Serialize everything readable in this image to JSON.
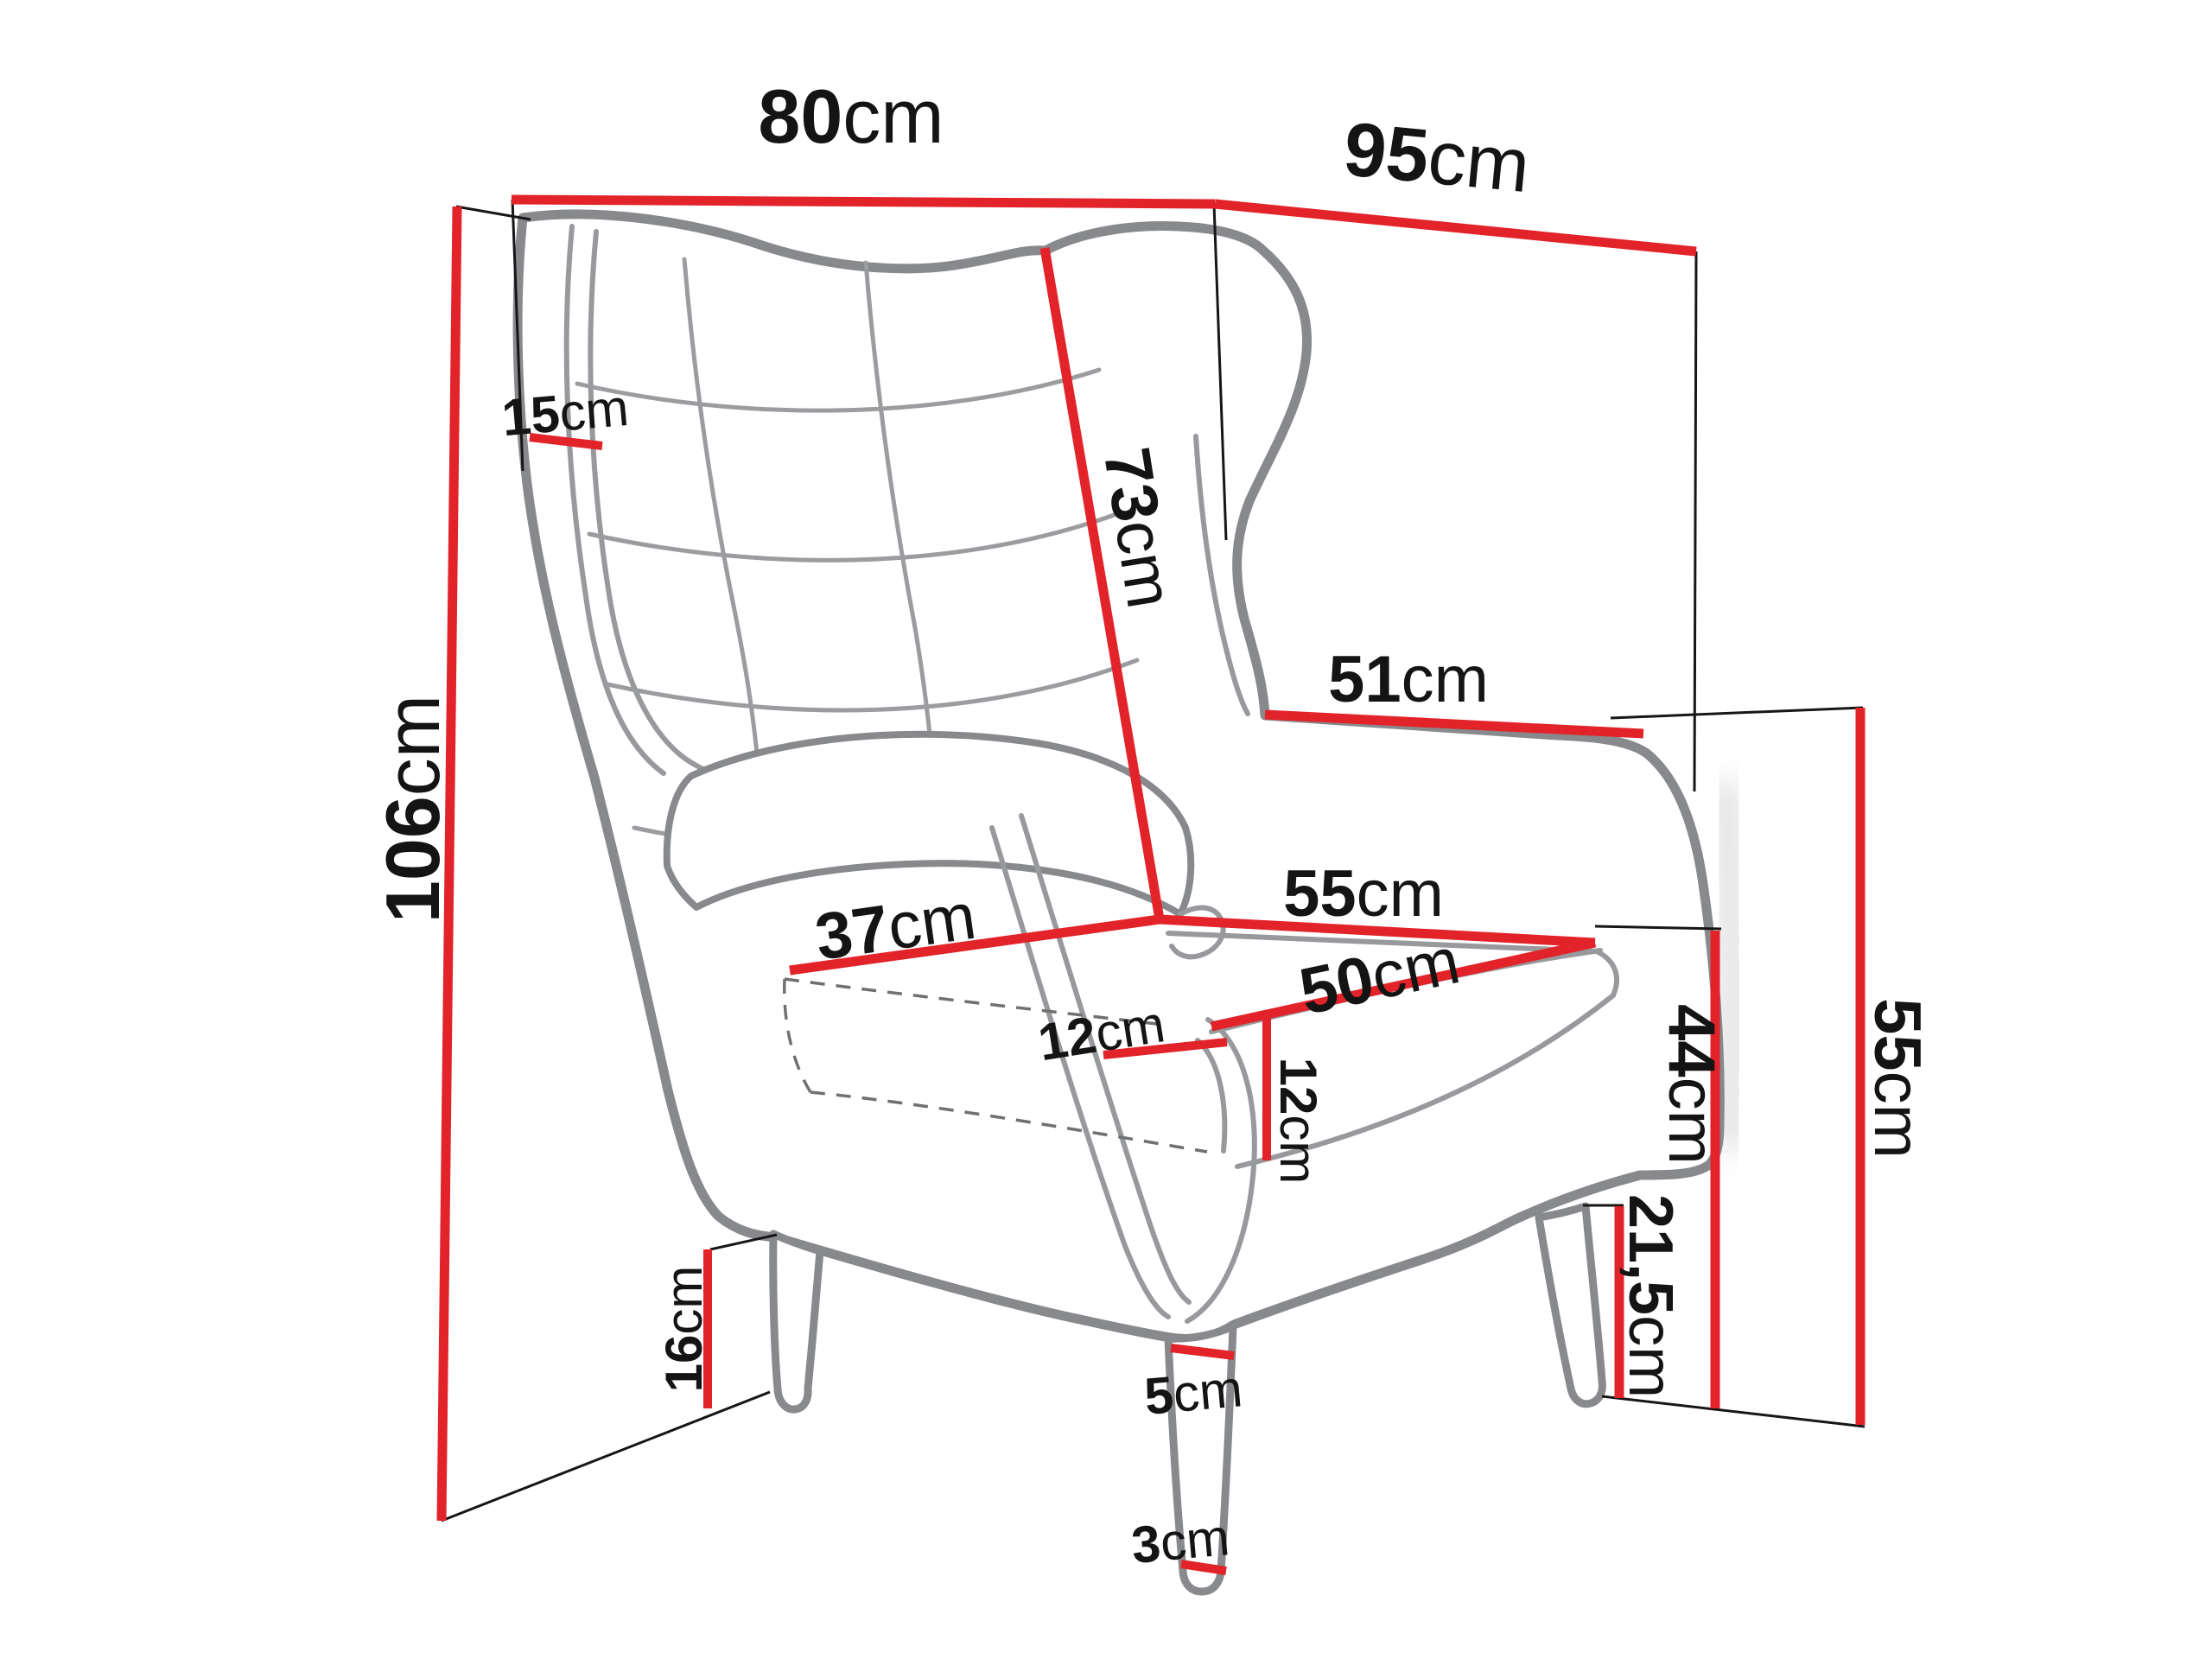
{
  "diagram": {
    "type": "furniture-dimension-drawing",
    "subject": "wingback armchair",
    "unit": "cm",
    "colors": {
      "dimension_line": "#e2232a",
      "chair_outline": "#87898c",
      "label_text": "#141414",
      "background": "#ffffff"
    },
    "dims": {
      "top_width": {
        "value": "80",
        "unit": "cm"
      },
      "top_depth": {
        "value": "95",
        "unit": "cm"
      },
      "total_height": {
        "value": "106",
        "unit": "cm"
      },
      "wing_depth": {
        "value": "15",
        "unit": "cm"
      },
      "backrest_length": {
        "value": "73",
        "unit": "cm"
      },
      "arm_top_depth": {
        "value": "51",
        "unit": "cm"
      },
      "seat_front_width": {
        "value": "37",
        "unit": "cm"
      },
      "seat_width": {
        "value": "55",
        "unit": "cm"
      },
      "seat_depth": {
        "value": "50",
        "unit": "cm"
      },
      "armrest_width": {
        "value": "12",
        "unit": "cm"
      },
      "cushion_height": {
        "value": "12",
        "unit": "cm"
      },
      "armrest_height": {
        "value": "55",
        "unit": "cm"
      },
      "seat_height": {
        "value": "44",
        "unit": "cm"
      },
      "front_leg_height": {
        "value": "21,5",
        "unit": "cm"
      },
      "back_leg_height": {
        "value": "16",
        "unit": "cm"
      },
      "leg_top_width": {
        "value": "5",
        "unit": "cm"
      },
      "leg_bottom_width": {
        "value": "3",
        "unit": "cm"
      }
    }
  }
}
